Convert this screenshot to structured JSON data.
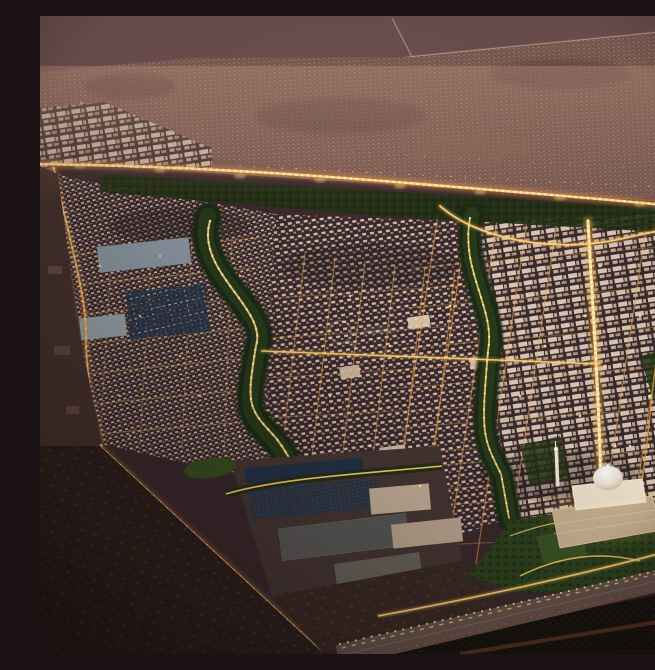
{
  "meta": {
    "description": "Dusk aerial rendering of a master-planned desert city: golden illuminated street grid, a winding dark-green valley park with a lit path, large solar-roof industrial campus, a grand domed mosque with lit minaret beside a southern highway, and hazy mauve desert with existing settlements on the horizon. A faint circular watermark sits near the center."
  },
  "palette": {
    "dusk_desert": "#7b5b53",
    "distant_settlement": "#8a685c",
    "city_shadow": "#3b2a2d",
    "building_light": "#e7d3bd",
    "street_glow": "#ffc966",
    "street_core": "#ffe9a8",
    "valley_green": "#27381b",
    "garden_green": "#2c421e",
    "solar_roof": "#26364a",
    "industrial_roof": "#8d99a4",
    "mosque_stone": "#f3e6cf",
    "highway_asphalt": "#6b574f",
    "taillight_red": "#d84b33",
    "foreground_desert": "#2c201b"
  },
  "regions": {
    "far_desert": "Far desert plain with faint roads",
    "distant_settlement": "Existing low-rise settlement band",
    "north_artery": "Illuminated northern boundary artery",
    "west_valley": "Winding green valley park, west branch",
    "central_valley": "Green valley park, central branch",
    "west_district": "Dense courtyard-housing district",
    "central_district": "Central residential grid",
    "east_district": "Eastern mixed-use grid",
    "main_boulevard": "Bright central boulevard toward mosque",
    "industrial_campus": "Industrial campus with solar roofs",
    "logistics_roofs": "Large flat-roof facilities",
    "mosque": "Grand mosque with ribbed dome",
    "minaret": "Floodlit minaret",
    "gardens": "Mosque gardens and lawns",
    "highway": "Southern highway with traffic lights",
    "foreground_desert": "Undeveloped desert foreground",
    "watermark": "Faint circular watermark"
  }
}
